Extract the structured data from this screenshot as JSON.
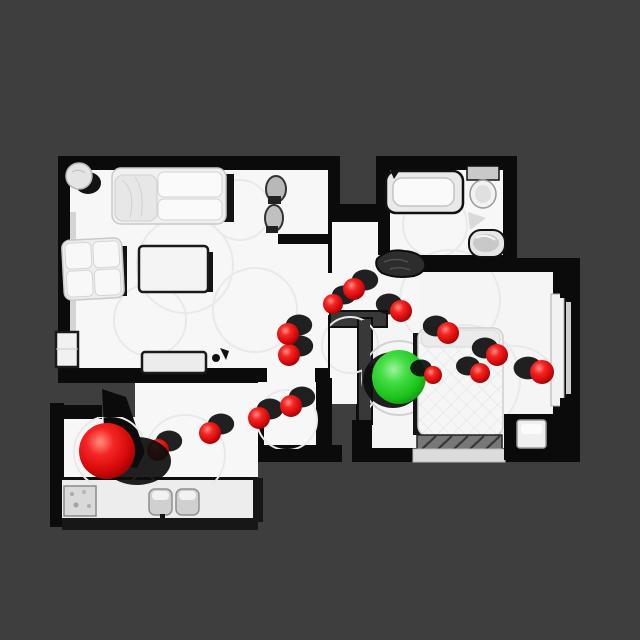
{
  "scene": {
    "type": "topdown-3d-scan-floorplan",
    "background_color": "#3e3e3e",
    "floor_color": "#f7f7f7",
    "wall_color": "#0b0b0b",
    "wall_top_color": "#383838"
  },
  "markers": {
    "start": {
      "label": "start-position-sphere",
      "color": "#e01010",
      "x": 107,
      "y": 451,
      "r": 28,
      "sdx": 30,
      "sdy": 10,
      "srx": 34,
      "sry": 24
    },
    "goal": {
      "label": "goal-position-sphere",
      "color": "#2fd32f",
      "x": 399,
      "y": 377,
      "r": 27,
      "sdx": -6,
      "sdy": 3,
      "srx": 30,
      "sry": 28
    },
    "waypoint_color": "#e01010",
    "waypoints": [
      {
        "x": 158,
        "y": 450,
        "r": 11,
        "sdx": 11,
        "sdy": -9
      },
      {
        "x": 210,
        "y": 433,
        "r": 11,
        "sdx": 11,
        "sdy": -9
      },
      {
        "x": 259,
        "y": 418,
        "r": 11,
        "sdx": 11,
        "sdy": -9
      },
      {
        "x": 291,
        "y": 406,
        "r": 11,
        "sdx": 11,
        "sdy": -9
      },
      {
        "x": 289,
        "y": 355,
        "r": 11,
        "sdx": 11,
        "sdy": -9
      },
      {
        "x": 288,
        "y": 334,
        "r": 11,
        "sdx": 11,
        "sdy": -9
      },
      {
        "x": 333,
        "y": 304,
        "r": 10,
        "sdx": 11,
        "sdy": -9
      },
      {
        "x": 354,
        "y": 289,
        "r": 11,
        "sdx": 11,
        "sdy": -9
      },
      {
        "x": 401,
        "y": 311,
        "r": 11,
        "sdx": -12,
        "sdy": -7
      },
      {
        "x": 448,
        "y": 333,
        "r": 11,
        "sdx": -12,
        "sdy": -7
      },
      {
        "x": 497,
        "y": 355,
        "r": 11,
        "sdx": -12,
        "sdy": -7
      },
      {
        "x": 480,
        "y": 373,
        "r": 10,
        "sdx": -12,
        "sdy": -7
      },
      {
        "x": 433,
        "y": 375,
        "r": 9,
        "sdx": -12,
        "sdy": -7
      },
      {
        "x": 542,
        "y": 372,
        "r": 12,
        "sdx": -14,
        "sdy": -4
      }
    ]
  }
}
